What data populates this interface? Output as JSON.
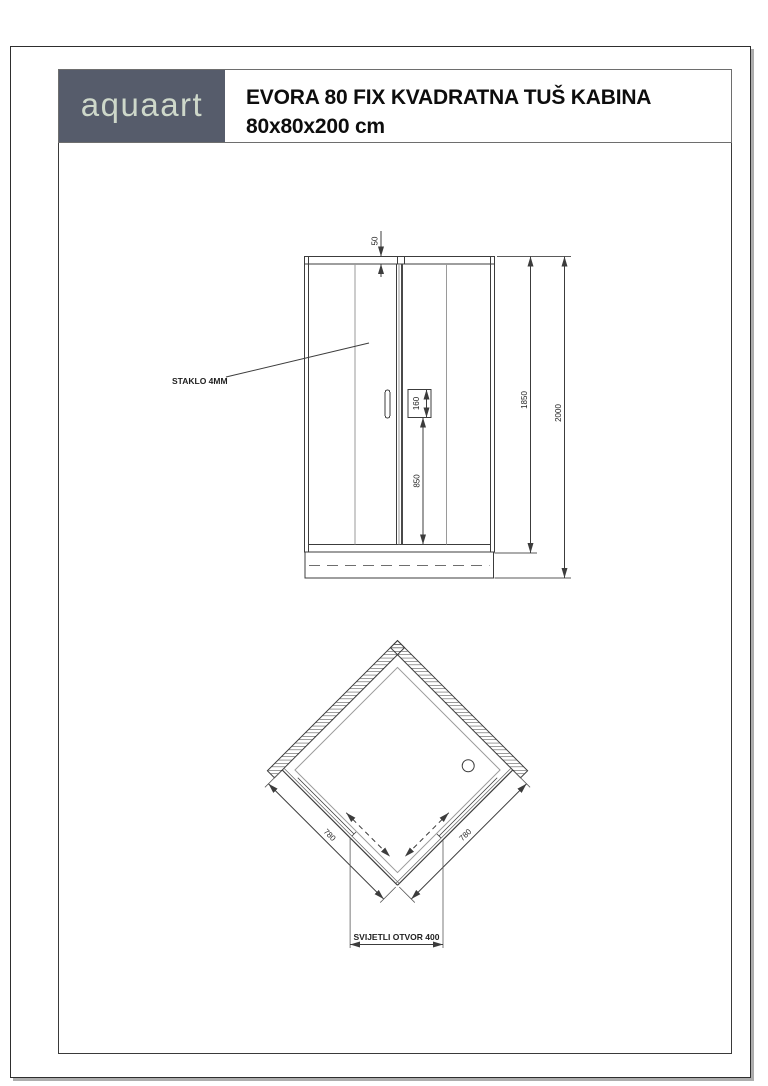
{
  "header": {
    "logo_text": "aquaart",
    "title_line1": "EVORA 80 FIX KVADRATNA TUŠ KABINA",
    "title_line2": "80x80x200 cm"
  },
  "front_view": {
    "glass_note": "STAKLO 4MM",
    "d50": "50",
    "d160": "160",
    "d850": "850",
    "d1850": "1850",
    "d2000": "2000"
  },
  "plan_view": {
    "d780_left": "780",
    "d780_right": "780",
    "opening_label": "SVIJETLI OTVOR 400"
  },
  "colors": {
    "logo_background": "#565c6b",
    "logo_text": "#ced8ca",
    "title_text": "#0d0d0d",
    "line_dark": "#3c3c3c",
    "line_gray": "#9a9a9a"
  }
}
